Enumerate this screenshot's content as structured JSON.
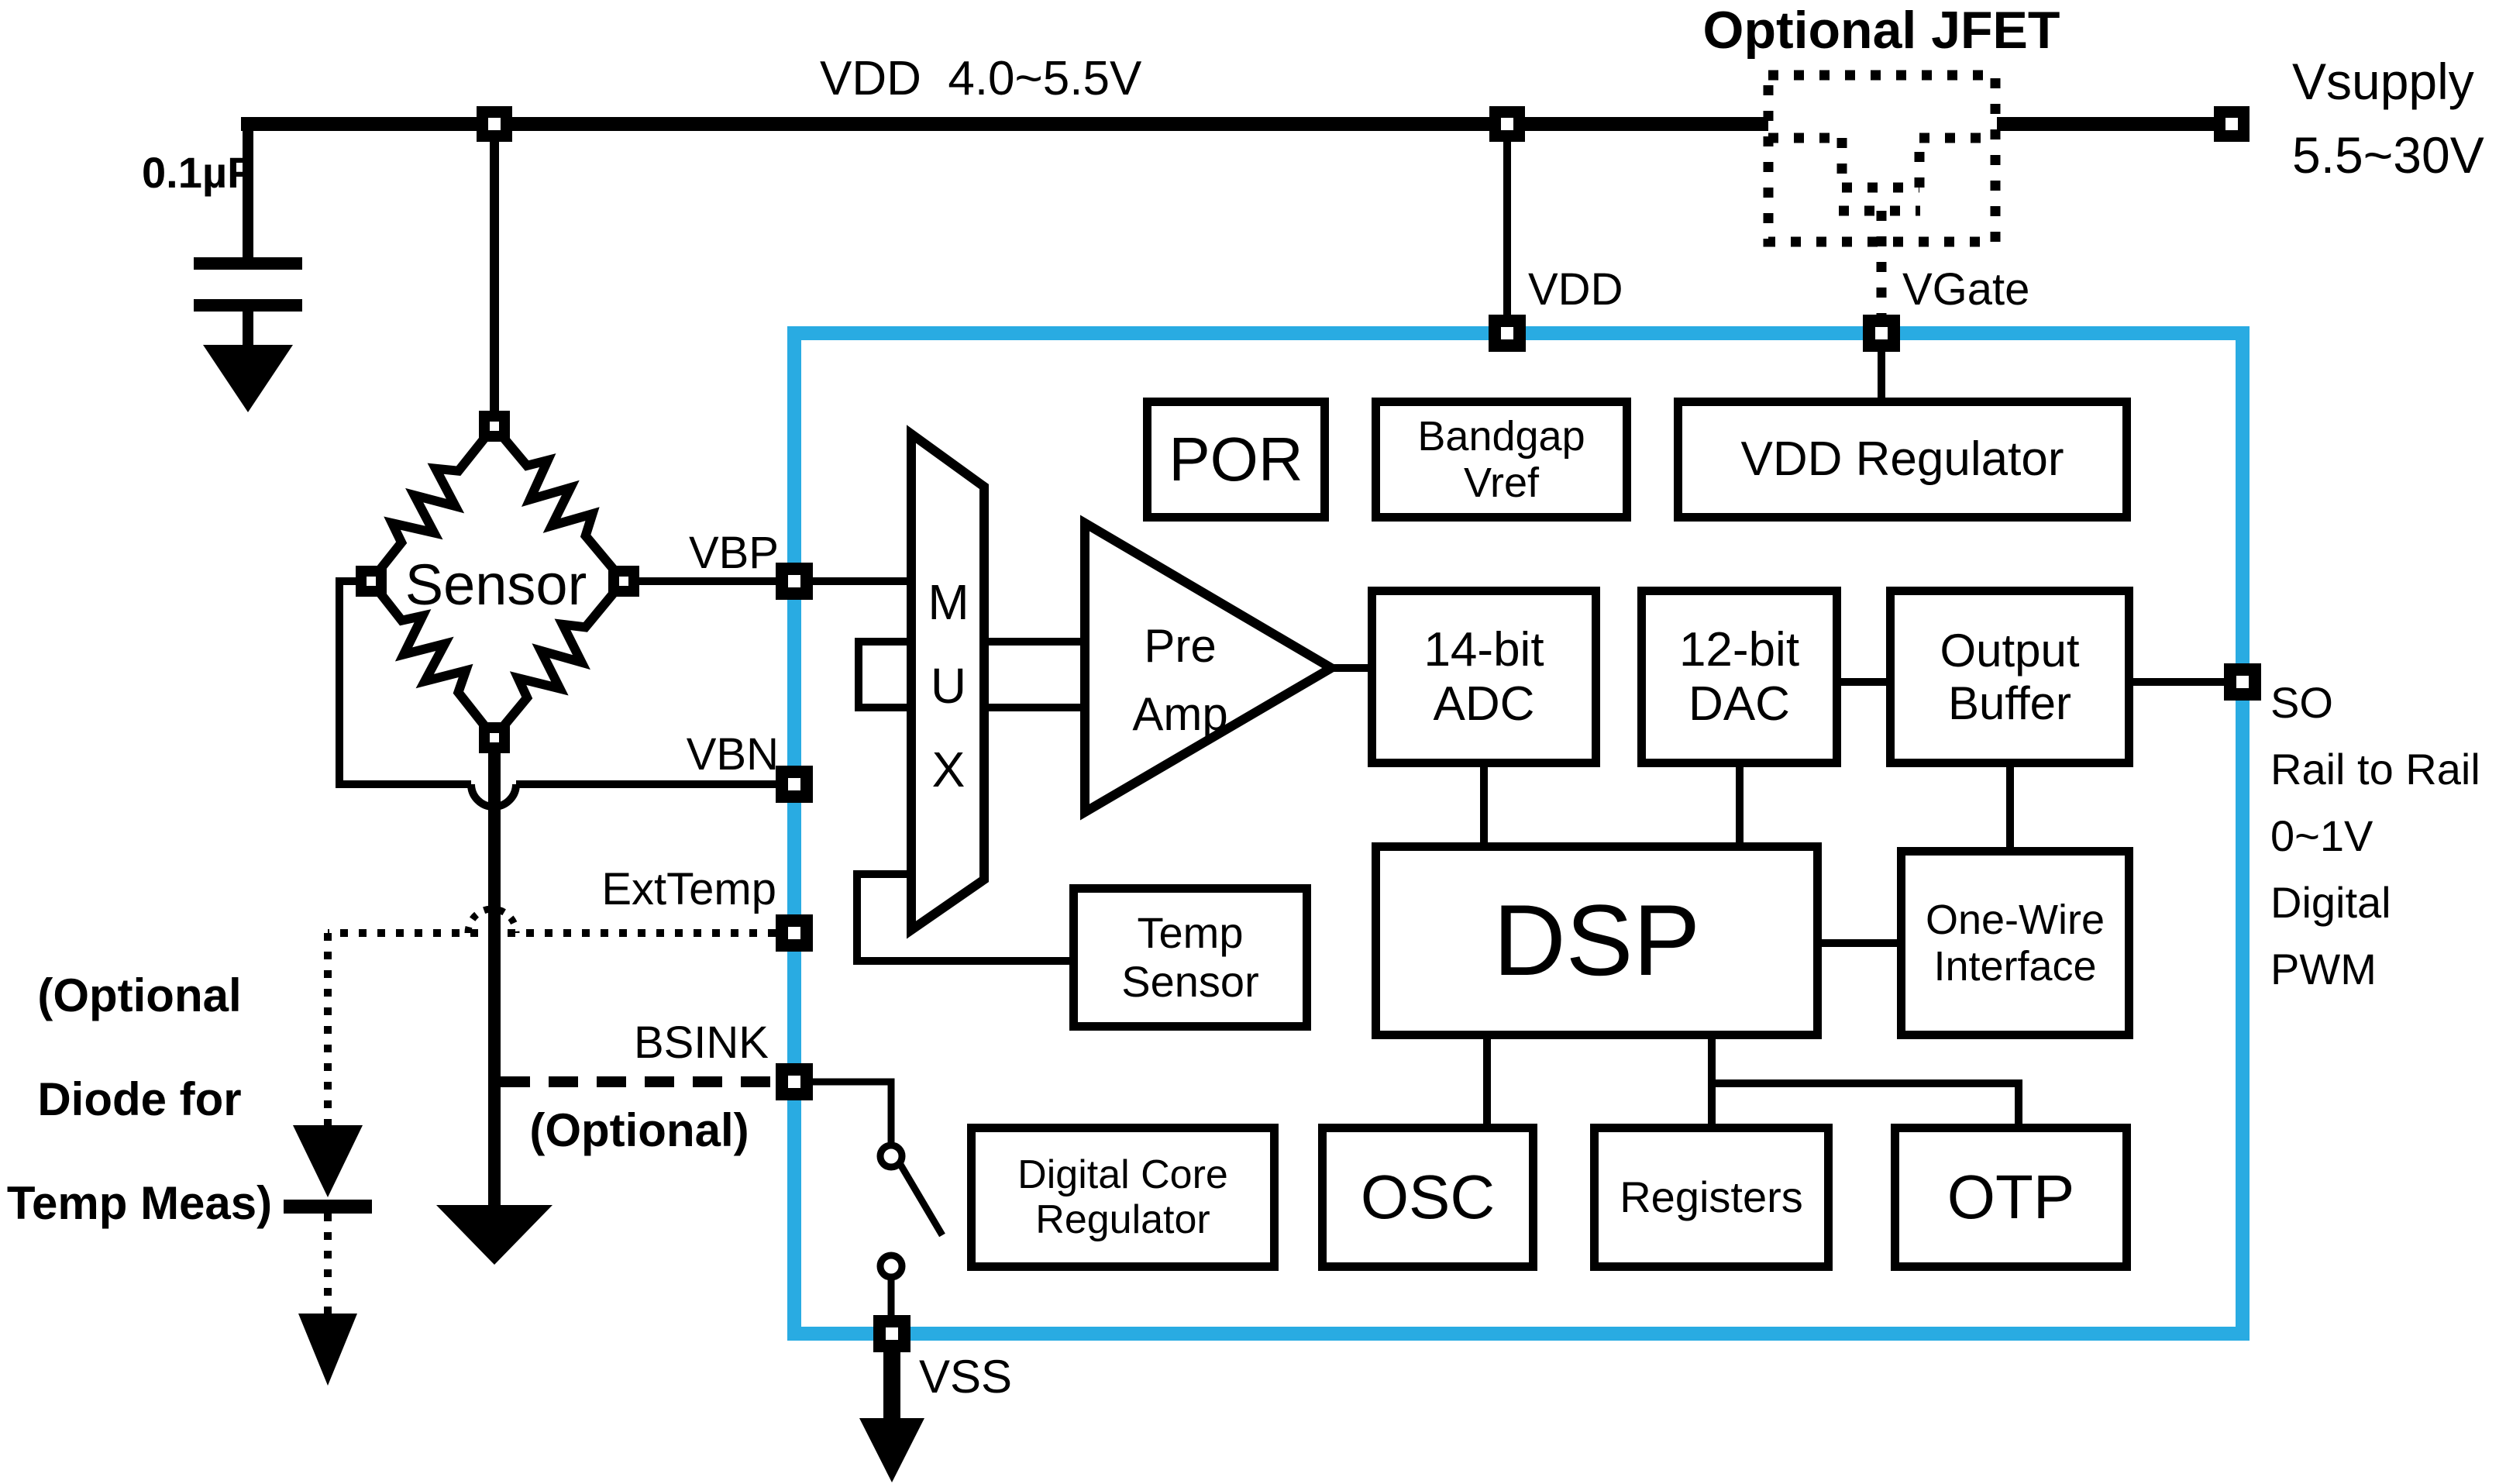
{
  "colors": {
    "chip_border": "#29ABE2",
    "wire": "#000000",
    "background": "#FFFFFF"
  },
  "top": {
    "rail_label": "VDD  4.0~5.5V",
    "cap_label": "0.1µF",
    "jfet_title": "Optional JFET",
    "vdd_pin_label": "VDD",
    "vgate_label": "VGate",
    "vsupply_lines": [
      "Vsupply",
      "5.5~30V"
    ]
  },
  "left": {
    "sensor_label": "Sensor",
    "vbp_label": "VBP",
    "vbn_label": "VBN",
    "exttemp_label": "ExtTemp",
    "bsink_label": "BSINK",
    "bsink_note": "(Optional)",
    "diode_note_lines": [
      "(Optional",
      "Diode for",
      "Temp Meas)"
    ]
  },
  "chip": {
    "mux_letters": [
      "M",
      "U",
      "X"
    ],
    "por": "POR",
    "bandgap": [
      "Bandgap",
      "Vref"
    ],
    "vdd_regulator": "VDD Regulator",
    "preamp": [
      "Pre",
      "Amp"
    ],
    "adc": [
      "14-bit",
      "ADC"
    ],
    "dac": [
      "12-bit",
      "DAC"
    ],
    "output_buffer": [
      "Output",
      "Buffer"
    ],
    "temp_sensor": [
      "Temp",
      "Sensor"
    ],
    "dsp": "DSP",
    "one_wire": [
      "One-Wire",
      "Interface"
    ],
    "digital_core_regulator": [
      "Digital Core",
      "Regulator"
    ],
    "osc": "OSC",
    "registers": "Registers",
    "otp": "OTP"
  },
  "right": {
    "so_block": [
      "SO",
      "Rail to Rail",
      "0~1V",
      "Digital",
      "PWM"
    ]
  },
  "bottom": {
    "vss_label": "VSS"
  }
}
